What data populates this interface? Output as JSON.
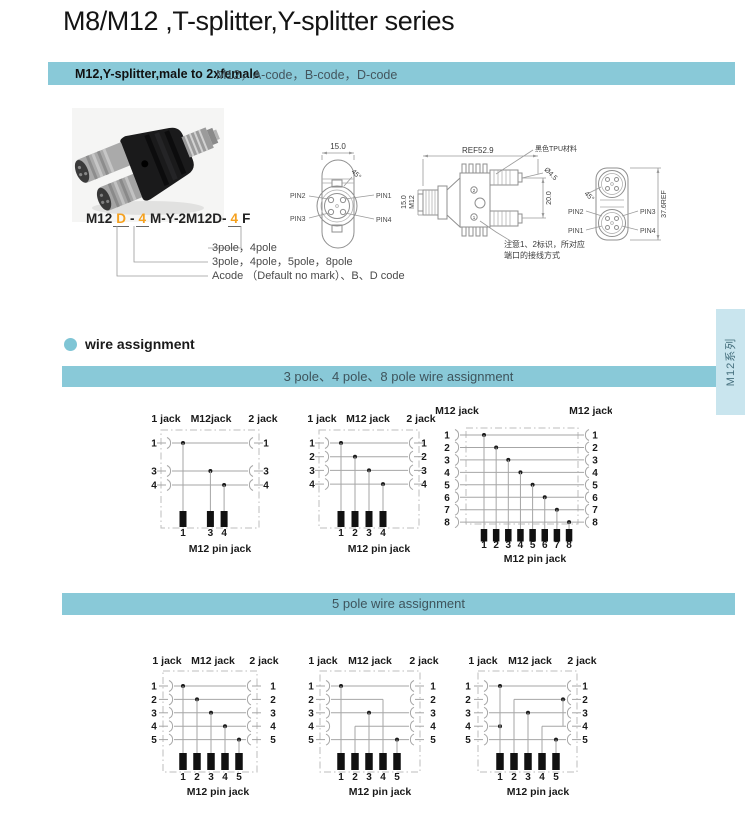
{
  "page": {
    "title": "M8/M12 ,T-splitter,Y-splitter series",
    "side_tab_label": "M12系列"
  },
  "header_bar": {
    "product": "M12,Y-splitter,male to 2xfemale",
    "codes": "M12，A-code，B-code，D-code"
  },
  "part_number": {
    "segments": [
      {
        "text": "M12",
        "mark": false
      },
      {
        "text": "D",
        "mark": true
      },
      {
        "text": "-",
        "mark": false
      },
      {
        "text": "4",
        "mark": true
      },
      {
        "text": "M-Y-2M12D-",
        "mark": false
      },
      {
        "text": "4",
        "mark": true
      },
      {
        "text": "F",
        "mark": false
      }
    ],
    "callouts": [
      "3pole，4pole",
      "3pole，4pole，5pole，8pole",
      "Acode （Default no mark）、B、D code"
    ]
  },
  "drawings": {
    "front_view": {
      "dim_width": "15.0",
      "dim_angle": "45°",
      "pin1": "PIN1",
      "pin2": "PIN2",
      "pin3": "PIN3",
      "pin4": "PIN4"
    },
    "side_view": {
      "dim_length": "REF52.9",
      "material_note": "黑色TPU材料",
      "dim_hole": "Ø4.5",
      "dim_port_pitch": "20.0",
      "dim_body": "15.0",
      "thread_size": "M12",
      "mark_top": "2",
      "mark_bottom": "1",
      "note_line1": "注意1、2标识，所对应",
      "note_line2": "端口的接线方式"
    },
    "rear_view": {
      "dim_height": "37.6REF",
      "dim_angle": "45°",
      "pin1": "PIN1",
      "pin2": "PIN2",
      "pin3": "PIN3",
      "pin4": "PIN4"
    }
  },
  "wire_assignment": {
    "section_title": "wire assignment",
    "bar_348": "3 pole、4 pole、8 pole wire assignment",
    "bar_5": "5 pole wire assignment",
    "diagrams": [
      {
        "id": "3pole",
        "top_labels": [
          "1 jack",
          "M12jack",
          "2 jack"
        ],
        "rows": [
          1,
          3,
          4
        ],
        "cols": [
          1,
          3,
          4
        ],
        "wires": [
          {
            "r": 1,
            "a": "L",
            "b": "R",
            "dot": 1
          },
          {
            "r": 3,
            "a": "L",
            "b": "R",
            "dot": 3
          },
          {
            "r": 4,
            "a": "L",
            "b": "R",
            "dot": 4
          }
        ],
        "drops": [
          {
            "c": 1,
            "r": 1
          },
          {
            "c": 3,
            "r": 3
          },
          {
            "c": 4,
            "r": 4
          }
        ],
        "bottom_label": "M12 pin jack"
      },
      {
        "id": "4pole",
        "top_labels": [
          "1 jack",
          "M12 jack",
          "2 jack"
        ],
        "rows": [
          1,
          2,
          3,
          4
        ],
        "cols": [
          1,
          2,
          3,
          4
        ],
        "wires": [
          {
            "r": 1,
            "a": "L",
            "b": "R",
            "dot": 1
          },
          {
            "r": 2,
            "a": "L",
            "b": "R",
            "dot": 2
          },
          {
            "r": 3,
            "a": "L",
            "b": "R",
            "dot": 3
          },
          {
            "r": 4,
            "a": "L",
            "b": "R",
            "dot": 4
          }
        ],
        "drops": [
          {
            "c": 1,
            "r": 1
          },
          {
            "c": 2,
            "r": 2
          },
          {
            "c": 3,
            "r": 3
          },
          {
            "c": 4,
            "r": 4
          }
        ],
        "bottom_label": "M12 pin jack"
      },
      {
        "id": "8pole",
        "top_labels": [
          "M12 jack",
          "M12 jack"
        ],
        "rows": [
          1,
          2,
          3,
          4,
          5,
          6,
          7,
          8
        ],
        "cols": [
          1,
          2,
          3,
          4,
          5,
          6,
          7,
          8
        ],
        "wires": [
          {
            "r": 1,
            "a": "L",
            "b": "R",
            "dot": 1
          },
          {
            "r": 2,
            "a": "L",
            "b": "R",
            "dot": 2
          },
          {
            "r": 3,
            "a": "L",
            "b": "R",
            "dot": 3
          },
          {
            "r": 4,
            "a": "L",
            "b": "R",
            "dot": 4
          },
          {
            "r": 5,
            "a": "L",
            "b": "R",
            "dot": 5
          },
          {
            "r": 6,
            "a": "L",
            "b": "R",
            "dot": 6
          },
          {
            "r": 7,
            "a": "L",
            "b": "R",
            "dot": 7
          },
          {
            "r": 8,
            "a": "L",
            "b": "R",
            "dot": 8
          }
        ],
        "drops": [
          {
            "c": 1,
            "r": 1
          },
          {
            "c": 2,
            "r": 2
          },
          {
            "c": 3,
            "r": 3
          },
          {
            "c": 4,
            "r": 4
          },
          {
            "c": 5,
            "r": 5
          },
          {
            "c": 6,
            "r": 6
          },
          {
            "c": 7,
            "r": 7
          },
          {
            "c": 8,
            "r": 8
          }
        ],
        "bottom_label": "M12 pin jack"
      },
      {
        "id": "5pole-a",
        "top_labels": [
          "1 jack",
          "M12 jack",
          "2 jack"
        ],
        "rows": [
          1,
          2,
          3,
          4,
          5
        ],
        "cols": [
          1,
          2,
          3,
          4,
          5
        ],
        "wires": [
          {
            "r": 1,
            "a": "L",
            "b": "R",
            "dot": 1
          },
          {
            "r": 2,
            "a": "L",
            "b": "R",
            "dot": 2
          },
          {
            "r": 3,
            "a": "L",
            "b": "R",
            "dot": 3
          },
          {
            "r": 4,
            "a": "L",
            "b": "R",
            "dot": 4
          },
          {
            "r": 5,
            "a": "L",
            "b": "R",
            "dot": 5
          }
        ],
        "drops": [
          {
            "c": 1,
            "r": 1
          },
          {
            "c": 2,
            "r": 2
          },
          {
            "c": 3,
            "r": 3
          },
          {
            "c": 4,
            "r": 4
          },
          {
            "c": 5,
            "r": 5
          }
        ],
        "bottom_label": "M12 pin jack"
      },
      {
        "id": "5pole-b",
        "top_labels": [
          "1 jack",
          "M12 jack",
          "2 jack"
        ],
        "rows": [
          1,
          2,
          3,
          4,
          5
        ],
        "cols": [
          1,
          2,
          3,
          4,
          5
        ],
        "wires": [
          {
            "r": 1,
            "a": "L",
            "b": "R",
            "dot": 1
          },
          {
            "r": 2,
            "a": "L",
            "b": 4
          },
          {
            "r": 3,
            "a": "L",
            "b": "R",
            "dot": 3
          },
          {
            "r": 4,
            "a": 2,
            "b": "R"
          },
          {
            "r": 5,
            "a": "L",
            "b": "R",
            "dot": 5
          }
        ],
        "drops": [
          {
            "c": 1,
            "r": 1
          },
          {
            "c": 2,
            "r": 4
          },
          {
            "c": 3,
            "r": 3
          },
          {
            "c": 4,
            "r": 2
          },
          {
            "c": 5,
            "r": 5
          }
        ],
        "bottom_label": "M12 pin jack"
      },
      {
        "id": "5pole-c",
        "top_labels": [
          "1 jack",
          "M12 jack",
          "2 jack"
        ],
        "rows": [
          1,
          2,
          3,
          4,
          5
        ],
        "cols": [
          1,
          2,
          3,
          4,
          5
        ],
        "wires": [
          {
            "r": 1,
            "a": "L",
            "b": "R",
            "dot": 1
          },
          {
            "r": 2,
            "a": 2,
            "b": "R",
            "dot": 5.5
          },
          {
            "r": 3,
            "a": "L",
            "b": "R",
            "dot": 3
          },
          {
            "r": 4,
            "a": "L",
            "b": 1,
            "dot": 1
          },
          {
            "r": 4,
            "a": 4,
            "b": "R"
          },
          {
            "r": 5,
            "a": "L",
            "b": "R",
            "dot": 5
          }
        ],
        "extra_v": [
          {
            "x": 5.5,
            "r1": 2,
            "r2": 4
          }
        ],
        "drops": [
          {
            "c": 1,
            "r": 1
          },
          {
            "c": 2,
            "r": 2
          },
          {
            "c": 3,
            "r": 3
          },
          {
            "c": 4,
            "r": 4
          },
          {
            "c": 5,
            "r": 5
          }
        ],
        "bottom_label": "M12 pin jack"
      }
    ]
  }
}
